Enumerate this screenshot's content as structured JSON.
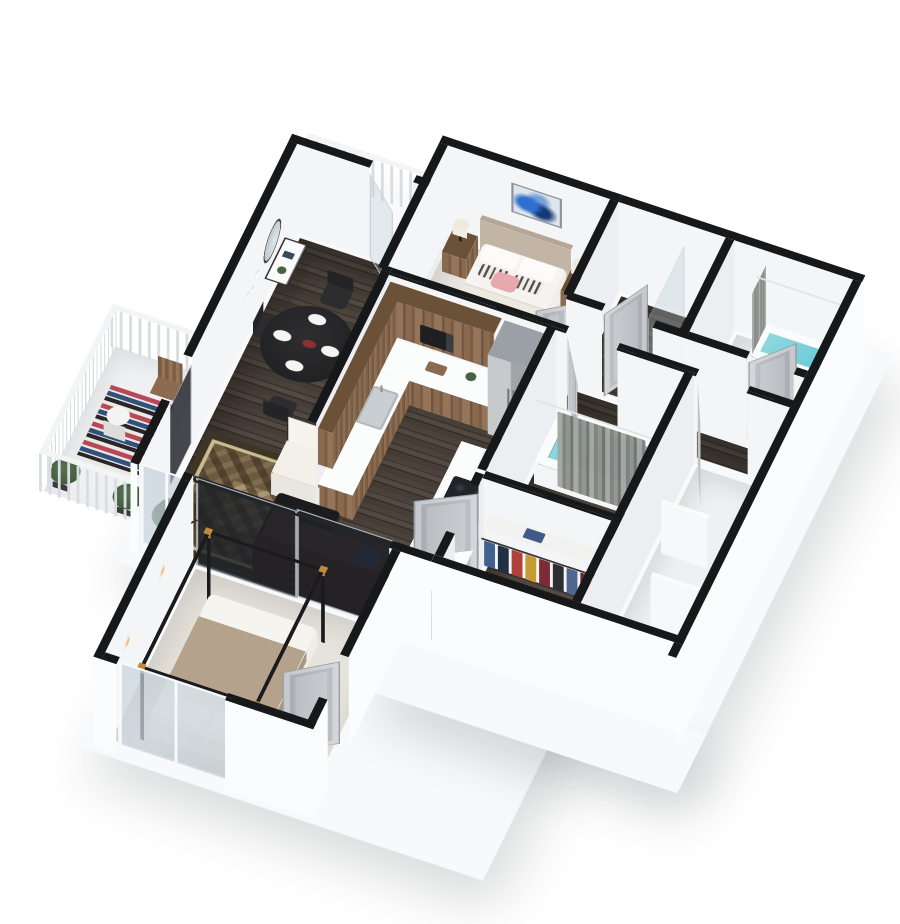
{
  "scene": {
    "kind": "isometric-3d-apartment-floor-plan-render",
    "view": "cutaway dollhouse view from above, white background, black wall caps"
  },
  "colors": {
    "bg": "#ffffff",
    "cap": "#17181a",
    "wall": "#f4f5f7",
    "wallside": "#eceef1",
    "wallouter": "#fbfcfd",
    "slab": "#f8f9fa",
    "cabinet": "#8a6a4f",
    "counter": "#fbfcfc",
    "carpet": "#eae7e1",
    "carpet2": "#e6e3dc",
    "tile": "#eef0f1",
    "floorwood": "#473f39",
    "steel": "#b6babd",
    "water": "#63c8d4",
    "curtain": "#8b8d89",
    "door": "#c3c8cd",
    "glassdark": "#1e2226",
    "brass": "#c08a3e",
    "sofa": "#4a2f23",
    "rug": "#8f7a58",
    "rugborder": "#3f3526",
    "art": "#2f6fd0",
    "pillowpink": "#e7a9ae",
    "throw": "#b4a28d",
    "plant": "#44633e",
    "blackfurniture": "#242424"
  },
  "rooms": [
    {
      "id": "bedroom-1",
      "furniture": [
        "double-bed",
        "headboard",
        "white-pillows",
        "striped-pillows",
        "pink-accent-pillow",
        "two-wood-nightstands",
        "two-table-lamps",
        "blue-abstract-wall-art",
        "window"
      ]
    },
    {
      "id": "kitchen",
      "furniture": [
        "u-shaped-wood-cabinets",
        "white-countertop",
        "upper-cabinets",
        "microwave",
        "stainless-fridge",
        "sink-with-faucet",
        "island-with-gas-cooktop",
        "coffee-maker",
        "cutting-board",
        "potted-plant"
      ]
    },
    {
      "id": "entry-dining",
      "furniture": [
        "round-black-dining-table",
        "four-black-rope-chairs",
        "place-settings",
        "white-console-table",
        "round-hanging-mirror",
        "wall-hooks",
        "glass-entry-door",
        "exterior-walkway-railing"
      ]
    },
    {
      "id": "living-room",
      "furniture": [
        "patterned-brown-rug",
        "tufted-brown-sofa",
        "white-armchair",
        "black-coffee-table",
        "drum-shade-floor-lamp",
        "potted-plant",
        "sliding-window"
      ]
    },
    {
      "id": "bathroom-center",
      "furniture": [
        "soaking-tub-with-water",
        "gray-shower-curtain",
        "curtain-rod",
        "vanity-with-basin",
        "toilet"
      ]
    },
    {
      "id": "bathroom-east",
      "furniture": [
        "tub-with-water",
        "shower-curtain",
        "vanity"
      ]
    },
    {
      "id": "bathroom-north",
      "furniture": [
        "glass-shower-panel",
        "doors"
      ]
    },
    {
      "id": "walk-in-closet",
      "furniture": [
        "hanging-clothes-multicolor",
        "closet-rod",
        "shelf",
        "folded-clothes"
      ]
    },
    {
      "id": "utility-room",
      "furniture": [
        "white-half-partitions",
        "toilet"
      ]
    },
    {
      "id": "bedroom-2",
      "furniture": [
        "black-canopy-bed-with-brass-corners",
        "tan-throw-blanket",
        "white-pillows",
        "sliding-window",
        "gray-door",
        "glass-slider-partition",
        "brass-floor-lamp",
        "wall-sconces"
      ]
    },
    {
      "id": "balcony",
      "furniture": [
        "white-railing",
        "striped-rug",
        "wood-chair",
        "round-side-table",
        "two-potted-plants"
      ]
    }
  ]
}
